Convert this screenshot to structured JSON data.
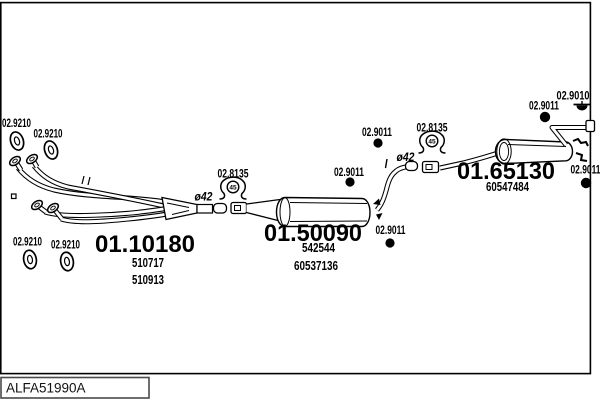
{
  "page": {
    "code_box": "ALFA51990A"
  },
  "parts": {
    "gasket": {
      "label": "02.9210"
    },
    "rubber_ring": {
      "label": "02.9011"
    },
    "mount": {
      "label": "02.8135",
      "bolt_mark": "45"
    },
    "hook": {
      "label": "02.9010"
    },
    "pipe_diameter": {
      "label": "ø42"
    },
    "front_pipe": {
      "number": "01.10180",
      "refs": [
        "510717",
        "510913"
      ]
    },
    "centre_muffler": {
      "number": "01.50090",
      "refs": [
        "542544",
        "60537136"
      ]
    },
    "rear_muffler": {
      "number": "01.65130",
      "refs": [
        "60547484"
      ]
    }
  }
}
